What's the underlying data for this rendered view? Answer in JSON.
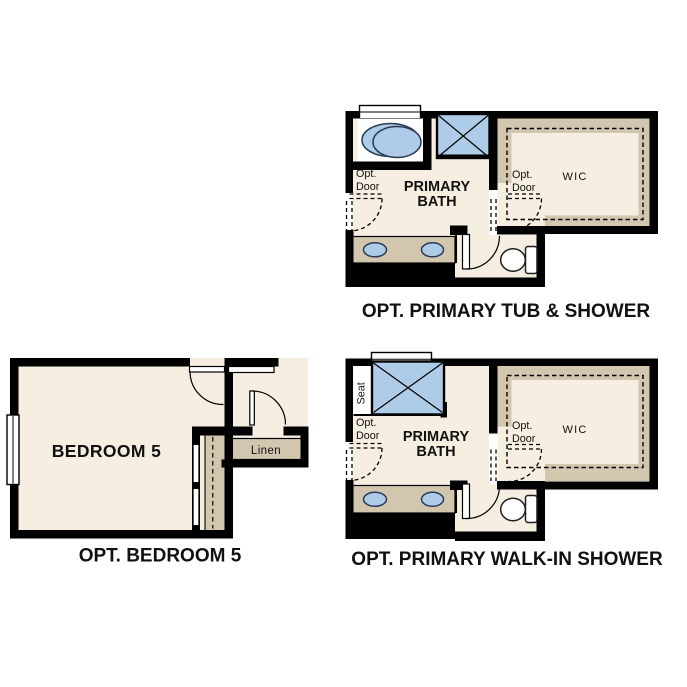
{
  "colors": {
    "background": "#ffffff",
    "floor": "#f5eee1",
    "tan": "#d2c6ae",
    "blue": "#aecbe8",
    "navy": "#2b3a55",
    "wall": "#000000",
    "text": "#111111"
  },
  "plans": {
    "tub_shower": {
      "caption": "OPT. PRIMARY TUB & SHOWER",
      "room_line1": "PRIMARY",
      "room_line2": "BATH",
      "closet": "WIC",
      "opt_door_line1": "Opt.",
      "opt_door_line2": "Door"
    },
    "walk_in_shower": {
      "caption": "OPT. PRIMARY WALK-IN SHOWER",
      "room_line1": "PRIMARY",
      "room_line2": "BATH",
      "closet": "WIC",
      "opt_door_line1": "Opt.",
      "opt_door_line2": "Door",
      "seat": "Seat"
    },
    "bedroom": {
      "caption": "OPT. BEDROOM 5",
      "room": "BEDROOM 5",
      "linen": "Linen"
    }
  }
}
